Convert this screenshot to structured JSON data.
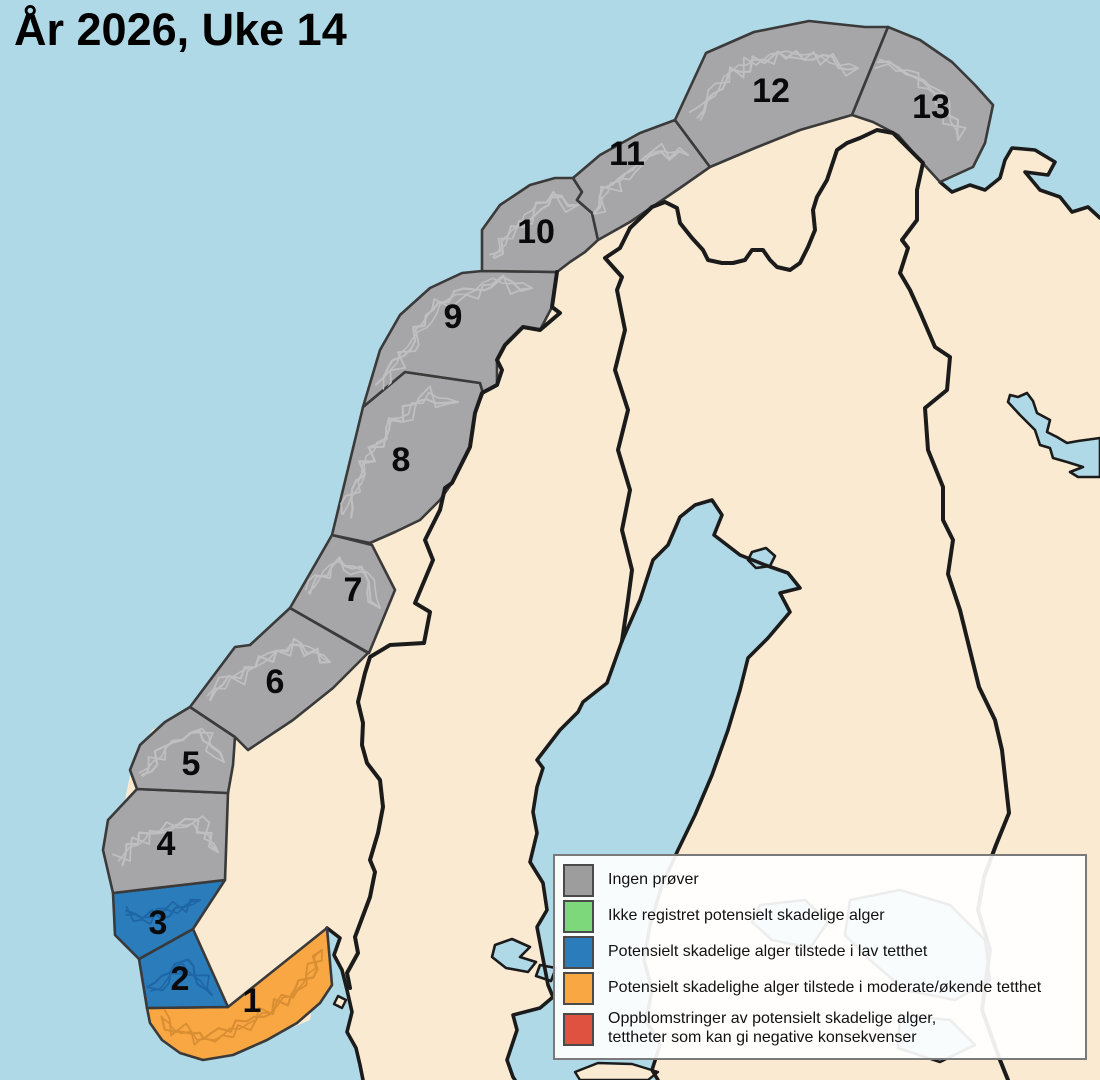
{
  "title": "År 2026, Uke 14",
  "legend": {
    "items": [
      {
        "color": "#9D9D9D",
        "label": "Ingen prøver"
      },
      {
        "color": "#7CD87A",
        "label": "Ikke registret potensielt skadelige alger"
      },
      {
        "color": "#2A7CBB",
        "label": "Potensielt skadelige alger tilstede i lav tetthet"
      },
      {
        "color": "#F9A742",
        "label": "Potensielt skadelighe alger tilstede i moderate/økende tetthet"
      },
      {
        "color": "#DF5240",
        "label": "Oppblomstringer av potensielt skadelige alger,",
        "label2": "tettheter som kan gi negative konsekvenser"
      }
    ]
  },
  "map": {
    "colors": {
      "sea": "#AFD9E6",
      "land": "#F9EAD1",
      "line": "#1B1B1B",
      "zoneStroke": "#3A3A3A",
      "label": "#0A0A0A",
      "grayFill": "#A6A6A8",
      "grayDetail": "#BFBFC1",
      "blueFill": "#2A7CBB",
      "blueDetail": "#1E66A6",
      "orangeFill": "#F9A742",
      "orangeDetail": "#D98E33"
    },
    "land": "M363,1080 L360,1065 356,1048 347,1032 352,1012 347,990 342,970 334,955 340,938 327,928 310,1020 250,1045 180,1040 150,1000 155,960 193,929 225,880 170,865 140,840 125,800 133,760 152,730 185,715 215,690 245,660 275,635 305,600 330,560 348,520 362,470 380,420 405,380 435,330 465,295 500,272 530,260 570,240 610,215 650,195 700,150 760,135 810,120 860,105 900,120 940,182 952,192 970,185 985,190 1000,178 1005,160 1012,148 1035,150 1055,162 1048,175 1025,172 1040,190 1060,197 1072,212 1088,207 1100,218 L1100,1080 L658,1080 652,1070 660,1045 646,1020 652,990 644,960 650,925 662,885 678,850 695,815 712,775 728,730 740,690 748,658 768,638 790,612 780,593 800,588 788,573 765,565 740,555 714,535 722,515 712,500 695,505 680,517 668,545 653,560 640,600 622,641 607,683 583,702 578,712 560,730 537,760 543,768 537,787 533,812 537,833 530,862 543,883 547,910 537,927 548,985 553,997 540,1008 513,1015 517,1030 507,1060 513,1077 515,1080 Z",
    "coasts": [
      {
        "name": "coast-oslofjord-kattegat",
        "d": "M327,928 L340,938 334,955 342,970 347,990 352,1012 347,1032 356,1048 360,1065 363,1080"
      },
      {
        "name": "coast-gulf-of-bothnia",
        "d": "M515,1080 L513,1077 507,1060 517,1030 513,1015 540,1008 553,997 548,985 537,927 547,910 543,883 530,862 537,833 533,812 537,787 543,768 537,760 560,730 578,712 583,702 607,683 622,641 640,600 653,560 668,545 680,517 695,505 712,500 722,515 714,535 740,555 765,565 788,573 800,588 780,593 790,612 768,638 748,658 740,690 728,730 712,775 695,815 678,850 662,885 650,925 644,960 652,990 646,1020 660,1045 652,1070 658,1080"
      },
      {
        "name": "coast-kola",
        "d": "M940,182 L952,192 970,185 985,190 1000,178 1005,160 1012,148 1035,150 1055,162 1048,175 1025,172 1040,190 1060,197 1072,212 1088,207 1100,218"
      }
    ],
    "borders": [
      {
        "name": "border-norway-sweden",
        "d": "M557,272 L552,307 560,313 540,330 523,327 505,345 497,360 502,370 497,385 482,393 475,413 470,447 452,483 445,488 440,510 425,540 433,560 415,603 430,612 424,643 390,645 370,657 365,673 358,702 363,723 362,745 367,763 380,780 383,807 378,833 370,860 375,872 370,897 355,937 358,953 347,973 350,988"
      },
      {
        "name": "border-norway-finland-russia",
        "d": "M630,228 L652,207 665,202 677,208 680,223 692,238 703,250 708,260 722,263 733,263 745,260 752,250 763,250 770,260 777,267 790,270 800,263 808,247 815,230 813,210 817,197 827,180 832,165 837,150 847,143 860,138 877,130 893,133 908,148 923,163 917,190 917,220 902,240 908,248 900,273 910,290 920,312 935,347 950,357 947,390 925,408 928,450 943,487 943,520 953,540 948,574 960,610 979,687 995,720 1002,750 1009,813 996,845 984,877 978,910 990,950 982,1010 1000,1060 1008,1080"
      },
      {
        "name": "border-sweden-finland",
        "d": "M630,228 L620,248 605,258 622,277 617,290 625,330 615,370 628,410 618,450 630,490 622,530 632,570 628,600 622,641"
      }
    ],
    "lakes": [
      {
        "name": "lake-inari",
        "d": "M1008,402 L1010,395 1018,397 1027,393 1033,401 1037,413 1050,420 1047,432 1057,437 1067,443 1078,441 1100,438 L1100,477 L1078,477 1070,472 1083,467 1067,462 1053,458 1050,448 1040,445 1035,430 1020,415 Z"
      },
      {
        "name": "lake-small-lapland",
        "d": "M752,552 L766,548 775,556 770,566 756,568 748,560 Z"
      },
      {
        "name": "lake-malaren",
        "d": "M495,945 L512,939 530,947 520,957 536,962 528,972 506,968 492,957 Z"
      },
      {
        "name": "lake-malaren-2",
        "d": "M540,965 L556,968 551,981 536,976 Z"
      },
      {
        "name": "lake-ghost-saimaa",
        "d": "M850,900 L900,890 950,905 985,940 990,980 955,1000 905,990 870,960 845,935 Z"
      },
      {
        "name": "lake-ghost-paijanne",
        "d": "M760,905 L805,900 828,922 810,948 772,940 752,922 Z"
      },
      {
        "name": "lake-ghost-ladoga",
        "d": "M900,1015 L950,1020 975,1045 940,1062 898,1048 Z"
      }
    ],
    "islands": [
      {
        "name": "island-oslofjord",
        "d": "M338,996 L346,1000 342,1008 334,1004 Z"
      },
      {
        "name": "island-baltic",
        "d": "M575,1072 L598,1063 632,1064 658,1072 648,1080 580,1080 Z"
      }
    ],
    "zones": [
      {
        "id": 1,
        "label": "1",
        "status": "moderate",
        "lx": 252,
        "ly": 1000,
        "points": [
          [
            327,
            928
          ],
          [
            332,
            985
          ],
          [
            320,
            1003
          ],
          [
            297,
            1023
          ],
          [
            267,
            1040
          ],
          [
            233,
            1055
          ],
          [
            203,
            1060
          ],
          [
            180,
            1053
          ],
          [
            162,
            1040
          ],
          [
            150,
            1023
          ],
          [
            147,
            1008
          ],
          [
            228,
            1007
          ]
        ],
        "spine": [
          [
            160,
            1020
          ],
          [
            205,
            1042
          ],
          [
            255,
            1018
          ],
          [
            300,
            992
          ],
          [
            322,
            950
          ]
        ]
      },
      {
        "id": 2,
        "label": "2",
        "status": "low",
        "lx": 180,
        "ly": 978,
        "points": [
          [
            139,
            959
          ],
          [
            193,
            929
          ],
          [
            228,
            1007
          ],
          [
            147,
            1008
          ]
        ],
        "spine": [
          [
            152,
            992
          ],
          [
            185,
            962
          ],
          [
            212,
            995
          ]
        ]
      },
      {
        "id": 3,
        "label": "3",
        "status": "low",
        "lx": 158,
        "ly": 922,
        "points": [
          [
            113,
            893
          ],
          [
            225,
            880
          ],
          [
            193,
            929
          ],
          [
            139,
            959
          ],
          [
            115,
            935
          ]
        ],
        "spine": [
          [
            126,
            912
          ],
          [
            160,
            916
          ],
          [
            200,
            900
          ]
        ]
      },
      {
        "id": 4,
        "label": "4",
        "status": "no-samples",
        "lx": 166,
        "ly": 843,
        "points": [
          [
            108,
            820
          ],
          [
            137,
            789
          ],
          [
            228,
            793
          ],
          [
            225,
            880
          ],
          [
            113,
            893
          ],
          [
            103,
            850
          ]
        ],
        "spine": [
          [
            118,
            860
          ],
          [
            150,
            832
          ],
          [
            195,
            822
          ],
          [
            218,
            852
          ]
        ]
      },
      {
        "id": 5,
        "label": "5",
        "status": "no-samples",
        "lx": 191,
        "ly": 763,
        "points": [
          [
            137,
            789
          ],
          [
            130,
            770
          ],
          [
            140,
            745
          ],
          [
            165,
            722
          ],
          [
            190,
            707
          ],
          [
            235,
            737
          ],
          [
            233,
            765
          ],
          [
            228,
            793
          ]
        ],
        "spine": [
          [
            142,
            775
          ],
          [
            165,
            748
          ],
          [
            200,
            730
          ],
          [
            224,
            762
          ]
        ]
      },
      {
        "id": 6,
        "label": "6",
        "status": "no-samples",
        "lx": 275,
        "ly": 681,
        "points": [
          [
            190,
            707
          ],
          [
            235,
            647
          ],
          [
            250,
            645
          ],
          [
            290,
            608
          ],
          [
            368,
            653
          ],
          [
            333,
            688
          ],
          [
            293,
            720
          ],
          [
            248,
            750
          ],
          [
            235,
            737
          ]
        ],
        "spine": [
          [
            208,
            696
          ],
          [
            248,
            672
          ],
          [
            292,
            642
          ],
          [
            330,
            662
          ]
        ]
      },
      {
        "id": 7,
        "label": "7",
        "status": "no-samples",
        "lx": 353,
        "ly": 589,
        "points": [
          [
            290,
            608
          ],
          [
            332,
            535
          ],
          [
            372,
            545
          ],
          [
            395,
            590
          ],
          [
            369,
            653
          ]
        ],
        "spine": [
          [
            308,
            592
          ],
          [
            338,
            562
          ],
          [
            368,
            572
          ],
          [
            380,
            608
          ]
        ]
      },
      {
        "id": 8,
        "label": "8",
        "status": "no-samples",
        "lx": 401,
        "ly": 459,
        "points": [
          [
            332,
            535
          ],
          [
            363,
            407
          ],
          [
            405,
            372
          ],
          [
            480,
            383
          ],
          [
            483,
            393
          ],
          [
            475,
            413
          ],
          [
            470,
            447
          ],
          [
            452,
            483
          ],
          [
            440,
            500
          ],
          [
            420,
            520
          ],
          [
            395,
            532
          ],
          [
            370,
            543
          ]
        ],
        "spine": [
          [
            345,
            515
          ],
          [
            365,
            465
          ],
          [
            392,
            422
          ],
          [
            428,
            395
          ],
          [
            458,
            402
          ]
        ]
      },
      {
        "id": 9,
        "label": "9",
        "status": "no-samples",
        "lx": 453,
        "ly": 316,
        "points": [
          [
            363,
            407
          ],
          [
            380,
            350
          ],
          [
            400,
            315
          ],
          [
            430,
            288
          ],
          [
            462,
            273
          ],
          [
            482,
            271
          ],
          [
            557,
            272
          ],
          [
            552,
            307
          ],
          [
            540,
            330
          ],
          [
            523,
            327
          ],
          [
            505,
            345
          ],
          [
            497,
            360
          ],
          [
            497,
            385
          ],
          [
            483,
            393
          ],
          [
            480,
            383
          ],
          [
            405,
            372
          ]
        ],
        "spine": [
          [
            382,
            388
          ],
          [
            412,
            338
          ],
          [
            448,
            300
          ],
          [
            492,
            282
          ],
          [
            532,
            288
          ]
        ]
      },
      {
        "id": 10,
        "label": "10",
        "status": "no-samples",
        "lx": 536,
        "ly": 231,
        "points": [
          [
            482,
            271
          ],
          [
            482,
            230
          ],
          [
            500,
            205
          ],
          [
            530,
            185
          ],
          [
            555,
            178
          ],
          [
            573,
            178
          ],
          [
            582,
            192
          ],
          [
            577,
            200
          ],
          [
            592,
            213
          ],
          [
            598,
            240
          ],
          [
            585,
            252
          ],
          [
            570,
            262
          ],
          [
            557,
            272
          ]
        ],
        "spine": [
          [
            492,
            256
          ],
          [
            520,
            222
          ],
          [
            552,
            196
          ],
          [
            578,
            205
          ]
        ]
      },
      {
        "id": 11,
        "label": "11",
        "status": "no-samples",
        "lx": 627,
        "ly": 153,
        "points": [
          [
            573,
            178
          ],
          [
            600,
            155
          ],
          [
            640,
            133
          ],
          [
            675,
            120
          ],
          [
            710,
            167
          ],
          [
            680,
            188
          ],
          [
            655,
            205
          ],
          [
            630,
            222
          ],
          [
            598,
            240
          ],
          [
            592,
            213
          ],
          [
            577,
            200
          ],
          [
            582,
            192
          ]
        ],
        "spine": [
          [
            592,
            212
          ],
          [
            618,
            178
          ],
          [
            652,
            152
          ],
          [
            688,
            155
          ]
        ]
      },
      {
        "id": 12,
        "label": "12",
        "status": "no-samples",
        "lx": 771,
        "ly": 90,
        "points": [
          [
            675,
            120
          ],
          [
            706,
            53
          ],
          [
            754,
            32
          ],
          [
            809,
            21
          ],
          [
            865,
            27
          ],
          [
            888,
            27
          ],
          [
            852,
            115
          ],
          [
            800,
            130
          ],
          [
            755,
            148
          ],
          [
            710,
            167
          ]
        ],
        "spine": [
          [
            698,
            118
          ],
          [
            732,
            72
          ],
          [
            778,
            52
          ],
          [
            822,
            58
          ],
          [
            858,
            68
          ]
        ]
      },
      {
        "id": 13,
        "label": "13",
        "status": "no-samples",
        "lx": 931,
        "ly": 106,
        "points": [
          [
            888,
            27
          ],
          [
            920,
            40
          ],
          [
            952,
            62
          ],
          [
            975,
            85
          ],
          [
            993,
            105
          ],
          [
            985,
            143
          ],
          [
            973,
            167
          ],
          [
            940,
            182
          ],
          [
            918,
            158
          ],
          [
            898,
            135
          ],
          [
            873,
            122
          ],
          [
            852,
            115
          ]
        ],
        "spine": [
          [
            878,
            62
          ],
          [
            915,
            78
          ],
          [
            948,
            102
          ],
          [
            958,
            140
          ]
        ]
      }
    ]
  }
}
